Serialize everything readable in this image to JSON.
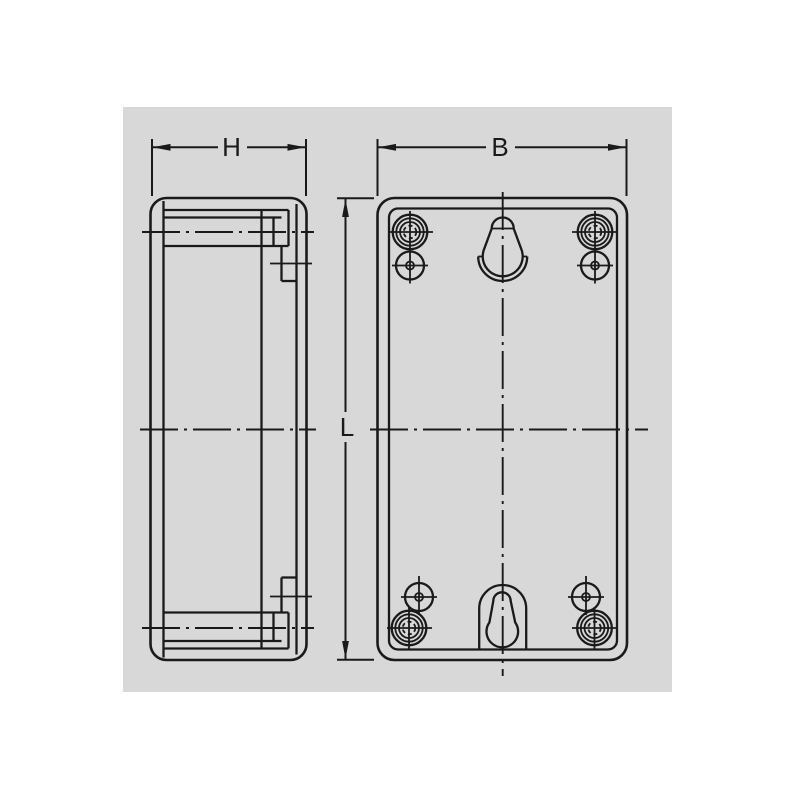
{
  "drawing": {
    "type": "technical-drawing",
    "subject": "enclosure two-view dimension drawing",
    "colors": {
      "page_background": "#ffffff",
      "canvas_background": "#d8d8d8",
      "line": "#1a1a1a"
    },
    "dimension_labels": {
      "side_depth": "H",
      "front_width": "B",
      "front_length": "L"
    }
  }
}
